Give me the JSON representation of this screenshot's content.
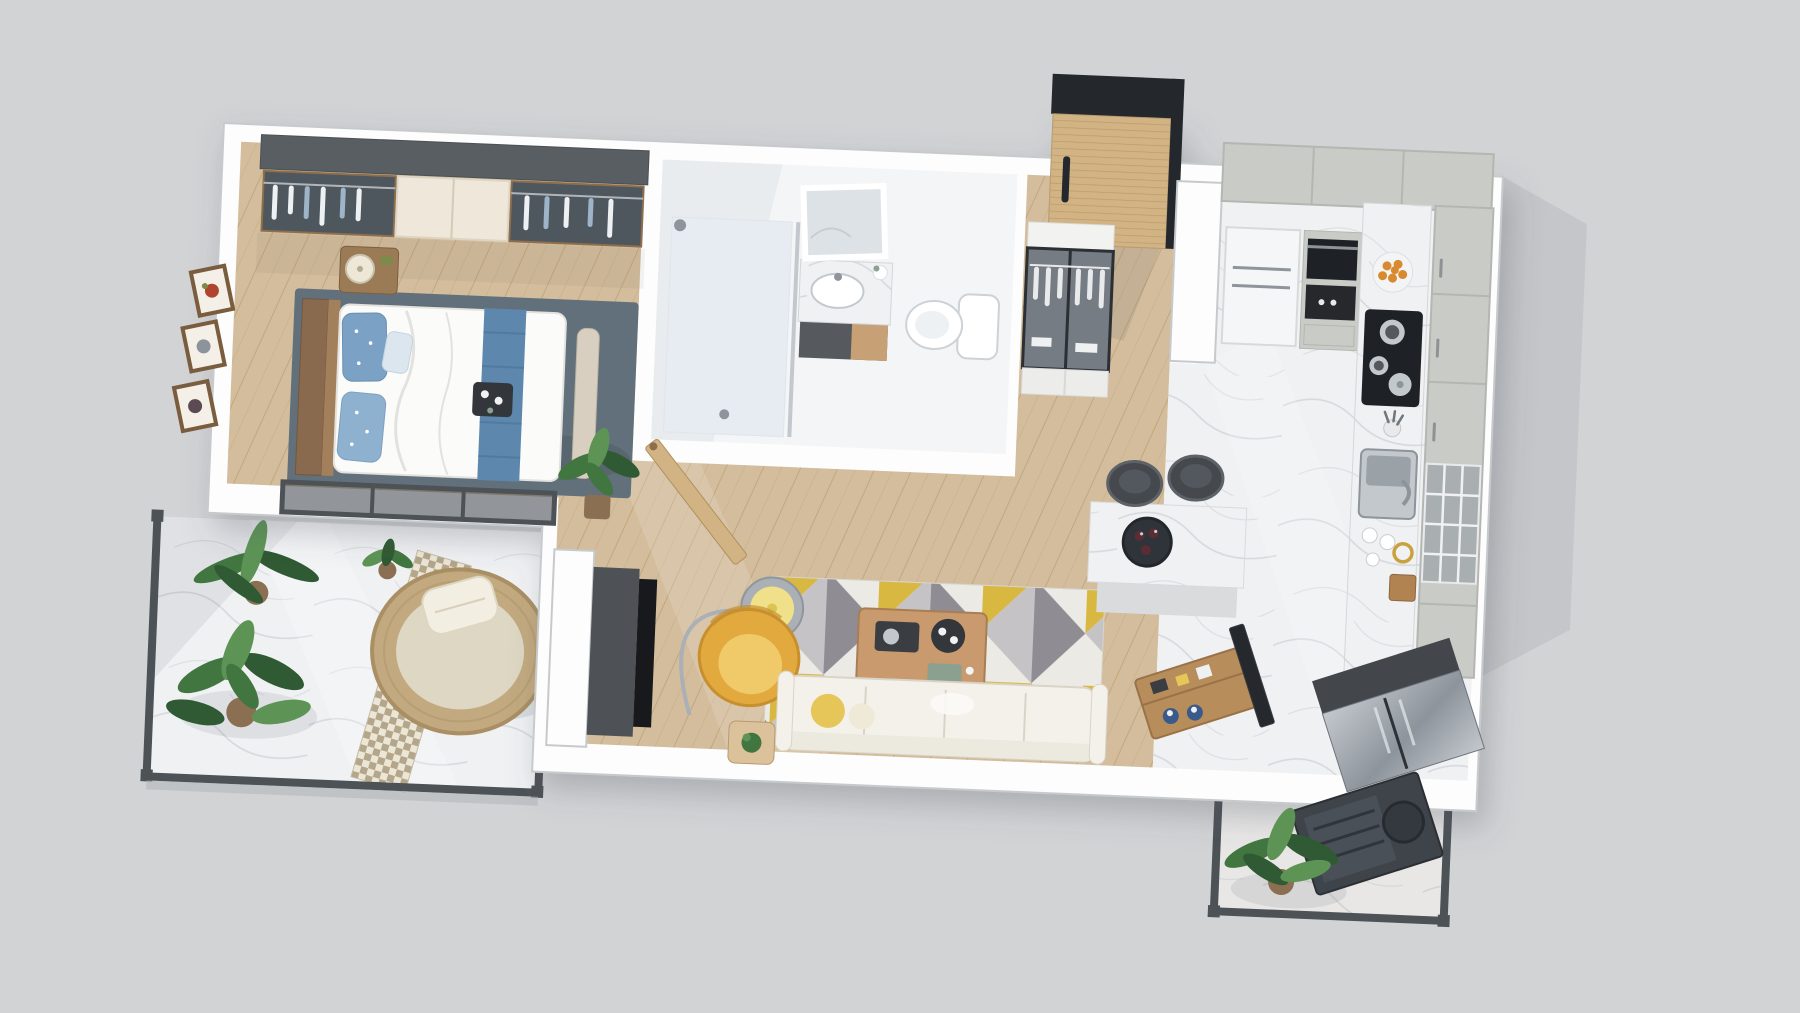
{
  "scene": {
    "description": "3D top-down rendered floor plan of a one-bedroom apartment with two balconies, open living-kitchen area, bathroom and entry hall",
    "view": "bird's-eye 3D render, slightly rotated clockwise",
    "background_color": "#d2d3d5"
  },
  "palette": {
    "bg": "#d2d3d5",
    "wall": "#fdfdfd",
    "wall_edge": "#c7cacd",
    "shadow": "#3c4654",
    "wood_base": "#d3bd9c",
    "wood_line": "#c2a77e",
    "marble_base": "#f0f1f3",
    "marble_vein": "#c9cdd3",
    "bath_floor": "#f3f5f7",
    "shower_tint": "#e6ecf1",
    "glass_dark": "#3a4149",
    "glass_tint": "#8e979e",
    "frame_dark": "#4d5257",
    "wardrobe_top": "#595e63",
    "wardrobe_door": "#efe8da",
    "wood_trim": "#8d6f4d",
    "bed_white": "#fbfbf9",
    "bed_shadow": "#e3e2de",
    "pillow_blue": "#7ba1c4",
    "runner_blue": "#5d87ad",
    "rug_slate": "#61707b",
    "headboard": "#8a6a4e",
    "nightstand": "#9b7a56",
    "lamp_shade": "#ece7d6",
    "picture_frame": "#7a5c3e",
    "plant_dark": "#2f5a33",
    "plant_mid": "#417640",
    "plant_light": "#5d9455",
    "pot": "#8a6f52",
    "rattan": "#c2a97f",
    "daybed_cushion": "#ded7c3",
    "pillow_white": "#f2eee2",
    "hound_a": "#b3a68a",
    "hound_b": "#ece6d6",
    "armchair": "#e2a93e",
    "armchair_dark": "#c78f2e",
    "lamp_steel": "#aab0b6",
    "lamp_glow": "#f0e08a",
    "rug_base": "#eceae5",
    "rug_gray": "#8f8c93",
    "rug_gray2": "#c5c3c6",
    "rug_yellow": "#d9b842",
    "table_wood": "#c89a6e",
    "table_wood_dark": "#a87e52",
    "tray_dark": "#33363b",
    "sofa": "#f4f1ea",
    "sofa_line": "#d9d4c7",
    "cushion_yellow": "#e6c559",
    "cabinet": "#c9cbc7",
    "cabinet_dark": "#b4b6b2",
    "appliance": "#1e2125",
    "steel_light": "#c3c8cd",
    "steel_mid": "#8d949b",
    "orange": "#d98a2e",
    "door_wood": "#d2b384",
    "door_slat": "#bb9a6a",
    "door_dark": "#24272b",
    "console_wood": "#b78d5b",
    "stool": "#45494e",
    "stool_rim": "#5d6268",
    "slab": "#c4c6c9",
    "gold": "#c9a23f",
    "blue_jar": "#3b5a8c",
    "black": "#17191c"
  },
  "rooms": [
    {
      "id": "bedroom",
      "label": "Bedroom",
      "floor": "wood",
      "furniture": [
        "glass-front wardrobe with dark top",
        "double bed with white duvet",
        "blue patterned pillows",
        "blue bed runner",
        "breakfast tray",
        "wood headboard with shelf",
        "nightstand with drum lamp",
        "foot-of-bed bench",
        "dark slate area rug",
        "three framed wall pictures",
        "sliding glass door to balcony"
      ]
    },
    {
      "id": "balcony-left",
      "label": "Bedroom balcony",
      "floor": "marble",
      "furniture": [
        "round rattan daybed with cushion and pillow",
        "houndstooth runner rug",
        "monstera floor plant",
        "palm floor plant",
        "small potted plant",
        "glass railing with dark frame"
      ]
    },
    {
      "id": "bathroom",
      "label": "Bathroom",
      "floor": "tile",
      "furniture": [
        "walk-in shower with glass partition",
        "marble vanity with basin",
        "standing framed mirror",
        "two-tone vanity cabinet",
        "toilet",
        "open wood door"
      ]
    },
    {
      "id": "entry-hall",
      "label": "Entry hall",
      "floor": "wood",
      "furniture": [
        "wood slat entrance door with black header",
        "glass-front hall wardrobe with white clothes",
        "drawer base"
      ]
    },
    {
      "id": "living-room",
      "label": "Living room",
      "floor": "wood",
      "furniture": [
        "geometric triangle rug in gray and yellow",
        "wood coffee table with trays and teapot",
        "white three-seat sofa with yellow pillow",
        "yellow armchair",
        "arc floor lamp with drum shade",
        "potted plant",
        "side table with succulent",
        "TV on dark media wall"
      ]
    },
    {
      "id": "kitchen",
      "label": "Kitchen",
      "floor": "marble",
      "furniture": [
        "light gray upper cabinets",
        "refrigerator",
        "built-in oven and microwave tower",
        "marble counter run",
        "gas cooktop with pots and kettle",
        "plate of oranges",
        "utensil crock",
        "stainless sink with faucet",
        "cups and gold bowl",
        "tall pantry cabinets",
        "glass mullion cabinet",
        "island with wine recess and bottles",
        "two dark bar stools",
        "wood media console with television",
        "stainless appliance column"
      ]
    },
    {
      "id": "balcony-right",
      "label": "Service balcony",
      "floor": "marble",
      "furniture": [
        "potted plant",
        "dark outdoor AC unit",
        "glass railing with dark frame"
      ]
    }
  ]
}
